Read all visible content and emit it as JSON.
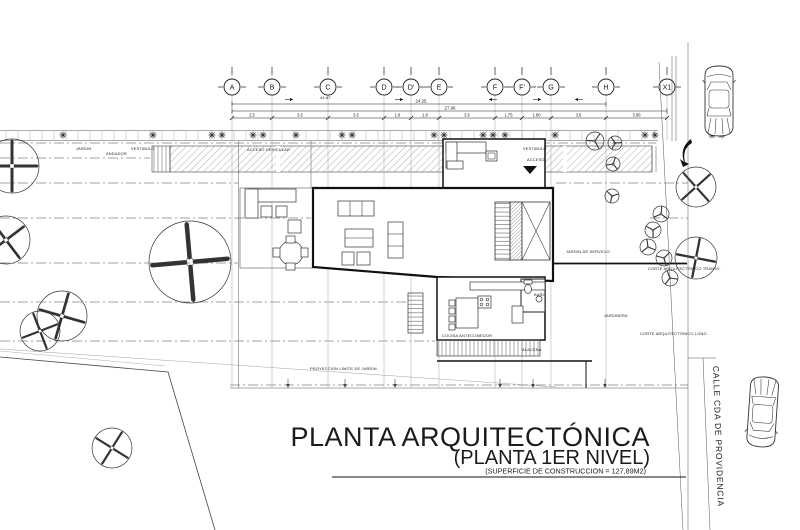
{
  "title": {
    "main": "PLANTA ARQUITECTÓNICA",
    "sub": "(PLANTA 1ER NIVEL)",
    "area_note": "(SUPERFICIE DE CONSTRUCCION = 127,89M2)"
  },
  "street": {
    "name": "CALLE CDA DE PROVIDENCIA"
  },
  "colors": {
    "line": "#1b1b1b",
    "gridline": "#9a9a9a",
    "annotation": "#222222"
  },
  "grid": {
    "bubble_y": 87,
    "bubbles": [
      {
        "label": "A",
        "x": 232
      },
      {
        "label": "B",
        "x": 272
      },
      {
        "label": "C",
        "x": 328
      },
      {
        "label": "D",
        "x": 384
      },
      {
        "label": "D'",
        "x": 411
      },
      {
        "label": "E",
        "x": 439
      },
      {
        "label": "F",
        "x": 495
      },
      {
        "label": "F'",
        "x": 522
      },
      {
        "label": "G",
        "x": 551
      },
      {
        "label": "H",
        "x": 606
      },
      {
        "label": "X1",
        "x": 667
      }
    ]
  },
  "dimensions": {
    "totals": [
      {
        "label": "24.25",
        "x1": 232,
        "x2": 606,
        "y": 104,
        "lx": 421
      },
      {
        "label": "27.96",
        "x1": 232,
        "x2": 667,
        "y": 111,
        "lx": 450
      }
    ],
    "chain_y": 118,
    "segments": [
      "2.5",
      "3.6",
      "3.6",
      "1.8",
      "1.8",
      "3.6",
      "1.75",
      "1.80",
      "3.6",
      "3.88"
    ],
    "arrows": [
      {
        "x": 285,
        "d": 1
      },
      {
        "x": 395,
        "d": 1
      },
      {
        "x": 497,
        "d": -1
      },
      {
        "x": 533,
        "d": 1
      },
      {
        "x": 583,
        "d": -1
      }
    ]
  },
  "annotations": [
    {
      "x": 76,
      "y": 150,
      "t": "JARDIN"
    },
    {
      "x": 106,
      "y": 155,
      "t": "ANDADOR"
    },
    {
      "x": 131,
      "y": 150,
      "t": "VESTIBULO"
    },
    {
      "x": 247,
      "y": 151,
      "t": "ACCESO VEHICULAR"
    },
    {
      "x": 320,
      "y": 99,
      "t": "44.87"
    },
    {
      "x": 523,
      "y": 150,
      "t": "VESTIBULO"
    },
    {
      "x": 527,
      "y": 161,
      "t": "ACCESO"
    },
    {
      "x": 534,
      "y": 296,
      "t": "BAÑO"
    },
    {
      "x": 522,
      "y": 351,
      "t": "ALACENA"
    },
    {
      "x": 442,
      "y": 337,
      "t": "COCINA ANTECOMEDOR"
    },
    {
      "x": 566,
      "y": 253,
      "t": "JARDIN DE SERVICIO"
    },
    {
      "x": 604,
      "y": 317,
      "t": "JARDINERA"
    },
    {
      "x": 640,
      "y": 335,
      "t": "CORTE ARQUITECTÓNICO LONG."
    },
    {
      "x": 648,
      "y": 270,
      "t": "CORTE ARQUITECTÓNICO TRANSV."
    },
    {
      "x": 310,
      "y": 370,
      "t": "PROYECCION LIMITE DE JARDIN"
    }
  ],
  "leader_arrows": [
    288,
    345,
    395,
    500,
    533,
    605
  ],
  "trees": [
    {
      "x": 12,
      "y": 166,
      "r": 27
    },
    {
      "x": 6,
      "y": 240,
      "r": 24
    },
    {
      "x": 62,
      "y": 316,
      "r": 25
    },
    {
      "x": 40,
      "y": 331,
      "r": 20
    },
    {
      "x": 112,
      "y": 448,
      "r": 20
    },
    {
      "x": 190,
      "y": 262,
      "r": 41
    },
    {
      "x": 696,
      "y": 187,
      "r": 20
    },
    {
      "x": 696,
      "y": 258,
      "r": 21
    },
    {
      "x": 595,
      "y": 141,
      "r": 9
    },
    {
      "x": 615,
      "y": 143,
      "r": 7
    },
    {
      "x": 613,
      "y": 164,
      "r": 7
    },
    {
      "x": 612,
      "y": 196,
      "r": 7
    },
    {
      "x": 661,
      "y": 214,
      "r": 8
    },
    {
      "x": 653,
      "y": 230,
      "r": 8
    },
    {
      "x": 648,
      "y": 247,
      "r": 8
    },
    {
      "x": 664,
      "y": 258,
      "r": 8
    },
    {
      "x": 670,
      "y": 278,
      "r": 8
    }
  ],
  "shrubs": {
    "y": 135,
    "xs": [
      63,
      153,
      212,
      222,
      253,
      263,
      296,
      342,
      352,
      434,
      444,
      483,
      493,
      505,
      555,
      645,
      655,
      712,
      722
    ]
  }
}
